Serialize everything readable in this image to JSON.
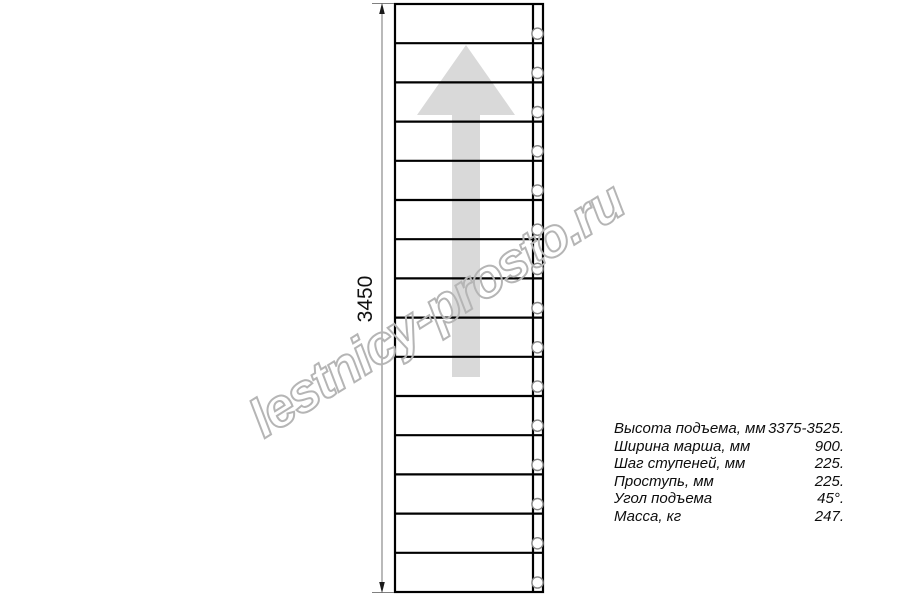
{
  "watermark": {
    "text": "lestnicy-prosto.ru",
    "color": "#b5b5b5"
  },
  "dimension": {
    "label": "3450"
  },
  "drawing": {
    "type": "staircase-plan-top-view",
    "steps_count": 15,
    "direction": "up",
    "colors": {
      "outline": "#000000",
      "arrow_fill": "#d9d9d9",
      "dimension_line": "#808080",
      "circle_stroke": "#878787"
    }
  },
  "specs": {
    "rows": [
      {
        "label": "Высота подъема, мм",
        "value": "3375-3525."
      },
      {
        "label": "Ширина марша, мм",
        "value": "900."
      },
      {
        "label": "Шаг ступеней, мм",
        "value": "225."
      },
      {
        "label": "Проступь, мм",
        "value": "225."
      },
      {
        "label": "Угол подъема",
        "value": "45°."
      },
      {
        "label": "Масса, кг",
        "value": "247."
      }
    ]
  }
}
